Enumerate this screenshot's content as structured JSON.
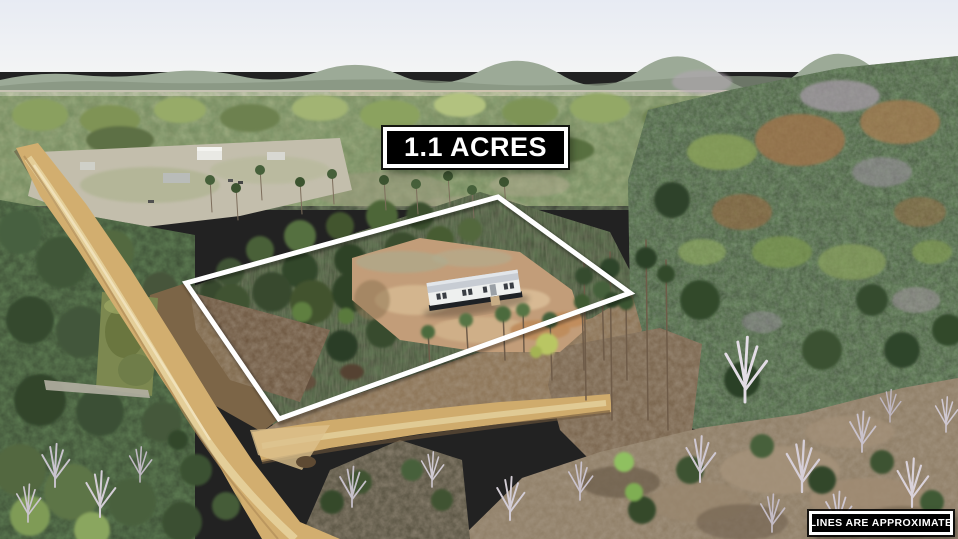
{
  "overlays": {
    "acreage": {
      "label": "1.1 ACRES"
    },
    "disclaimer": {
      "label": "LINES ARE APPROXIMATE"
    }
  },
  "colors": {
    "boundary_line": "#ffffff",
    "label_background": "#000000",
    "label_border": "#ffffff",
    "label_text": "#ffffff",
    "dirt_road": "#d2ae6f",
    "cleared_dirt": "#c29d79",
    "pine_forest_dark": "#3d4632",
    "spring_canopy_light": "#9db069",
    "sky": "#e9edf4"
  },
  "scene": {
    "kind": "aerial-drone-photo",
    "features": [
      "pine-forest",
      "dirt-road",
      "road-fork",
      "cleared-lot",
      "mobile-home",
      "property-boundary-polygon",
      "scrub-field",
      "bare-winter-trees",
      "distant-horizon"
    ]
  }
}
